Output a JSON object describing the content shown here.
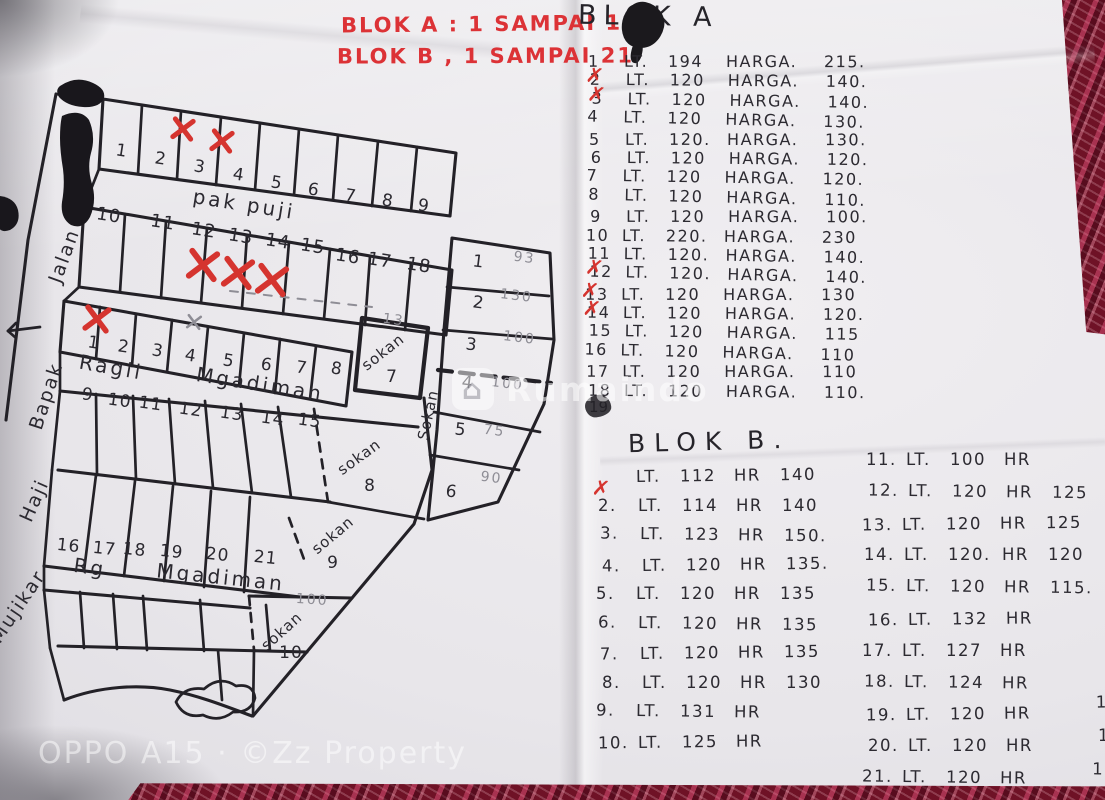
{
  "photo": {
    "bottom_watermark": "OPPO A15 · ©Zz Property",
    "site_watermark": "Rumaindo"
  },
  "notes_header": {
    "line1": "BLOK A : 1 SAMPAI 18",
    "line2": "BLOK B , 1 SAMPAI 21"
  },
  "blok_a": {
    "title": "BLOK A",
    "lt_label": "LT.",
    "harga_label": "HARGA.",
    "struck_entry": "19",
    "rows": [
      {
        "no": "1",
        "lt": "194",
        "harga": "215.",
        "crossed": false
      },
      {
        "no": "2",
        "lt": "120",
        "harga": "140.",
        "crossed": true
      },
      {
        "no": "3",
        "lt": "120",
        "harga": "140.",
        "crossed": true
      },
      {
        "no": "4",
        "lt": "120",
        "harga": "130.",
        "crossed": false
      },
      {
        "no": "5",
        "lt": "120.",
        "harga": "130.",
        "crossed": false
      },
      {
        "no": "6",
        "lt": "120",
        "harga": "120.",
        "crossed": false
      },
      {
        "no": "7",
        "lt": "120",
        "harga": "120.",
        "crossed": false
      },
      {
        "no": "8",
        "lt": "120",
        "harga": "110.",
        "crossed": false
      },
      {
        "no": "9",
        "lt": "120",
        "harga": "100.",
        "crossed": false
      },
      {
        "no": "10",
        "lt": "220.",
        "harga": "230",
        "crossed": false
      },
      {
        "no": "11",
        "lt": "120.",
        "harga": "140.",
        "crossed": false
      },
      {
        "no": "12",
        "lt": "120.",
        "harga": "140.",
        "crossed": true
      },
      {
        "no": "13",
        "lt": "120",
        "harga": "130",
        "crossed": true
      },
      {
        "no": "14",
        "lt": "120",
        "harga": "120.",
        "crossed": true
      },
      {
        "no": "15",
        "lt": "120",
        "harga": "115",
        "crossed": false
      },
      {
        "no": "16",
        "lt": "120",
        "harga": "110",
        "crossed": false
      },
      {
        "no": "17",
        "lt": "120",
        "harga": "110",
        "crossed": false
      },
      {
        "no": "18",
        "lt": "120",
        "harga": "110.",
        "crossed": false
      }
    ]
  },
  "blok_b": {
    "title": "BLOK B.",
    "lt_label": "LT.",
    "hr_label": "HR",
    "rows": [
      {
        "no": "",
        "lt": "112",
        "hr": "140",
        "crossed": true
      },
      {
        "no": "2.",
        "lt": "114",
        "hr": "140",
        "crossed": false
      },
      {
        "no": "3.",
        "lt": "123",
        "hr": "150.",
        "crossed": false
      },
      {
        "no": "4.",
        "lt": "120",
        "hr": "135.",
        "crossed": false
      },
      {
        "no": "5.",
        "lt": "120",
        "hr": "135",
        "crossed": false
      },
      {
        "no": "6.",
        "lt": "120",
        "hr": "135",
        "crossed": false
      },
      {
        "no": "7.",
        "lt": "120",
        "hr": "135",
        "crossed": false
      },
      {
        "no": "8.",
        "lt": "120",
        "hr": "130",
        "crossed": false
      },
      {
        "no": "9.",
        "lt": "131",
        "hr": "",
        "crossed": false
      },
      {
        "no": "10.",
        "lt": "125",
        "hr": "",
        "crossed": false
      },
      {
        "no": "11.",
        "lt": "100",
        "hr": "",
        "crossed": false
      },
      {
        "no": "12.",
        "lt": "120",
        "hr": "125",
        "crossed": false
      },
      {
        "no": "13.",
        "lt": "120",
        "hr": "125",
        "crossed": false
      },
      {
        "no": "14.",
        "lt": "120.",
        "hr": "120",
        "crossed": false
      },
      {
        "no": "15.",
        "lt": "120",
        "hr": "115.",
        "crossed": false
      },
      {
        "no": "16.",
        "lt": "132",
        "hr": "",
        "crossed": false
      },
      {
        "no": "17.",
        "lt": "127",
        "hr": "",
        "crossed": false
      },
      {
        "no": "18.",
        "lt": "124",
        "hr": "",
        "crossed": false
      },
      {
        "no": "19.",
        "lt": "120",
        "hr": "100",
        "crossed": false
      },
      {
        "no": "20.",
        "lt": "120",
        "hr": "100",
        "crossed": false
      },
      {
        "no": "21.",
        "lt": "120",
        "hr": "100",
        "crossed": false
      }
    ]
  },
  "map": {
    "row1_plots": [
      "1",
      "2",
      "3",
      "4",
      "5",
      "6",
      "7",
      "8",
      "9"
    ],
    "row1_crossed": [
      "2",
      "3"
    ],
    "row2_plots": [
      "10",
      "11",
      "12",
      "13",
      "14",
      "15",
      "16",
      "17",
      "18"
    ],
    "row2_crossed": [
      "12",
      "13",
      "14"
    ],
    "row3_plots": [
      "1",
      "2",
      "3",
      "4",
      "5",
      "6",
      "7",
      "8"
    ],
    "row3_crossed": [
      "1"
    ],
    "row3_pencil_crossed": [
      "4"
    ],
    "row4_plots": [
      "9",
      "10",
      "11",
      "12",
      "13",
      "14",
      "15"
    ],
    "row5_plots": [
      "16",
      "17",
      "18",
      "19",
      "20",
      "21"
    ],
    "right_plots": [
      {
        "no": "1",
        "area": "93"
      },
      {
        "no": "2",
        "area": "130"
      },
      {
        "no": "3",
        "area": "100"
      },
      {
        "no": "4",
        "area": "100"
      },
      {
        "no": "5",
        "area": "75"
      },
      {
        "no": "6",
        "area": "90"
      }
    ],
    "sokan_label": "sokan",
    "sokan_plots": [
      {
        "no": "7",
        "area": "13"
      },
      {
        "no": "8",
        "area": ""
      },
      {
        "no": "9",
        "area": ""
      },
      {
        "no": "10",
        "area": "100"
      }
    ],
    "roads": {
      "top": "pak puji",
      "mid_left": "Ragil",
      "mid": "Mgadiman",
      "low_left": "Rg",
      "low": "Mgadiman",
      "right_vertical": "Sokan",
      "left_vertical": [
        "Jalan",
        "Bapak",
        "Haji",
        "Mujikar"
      ]
    }
  }
}
